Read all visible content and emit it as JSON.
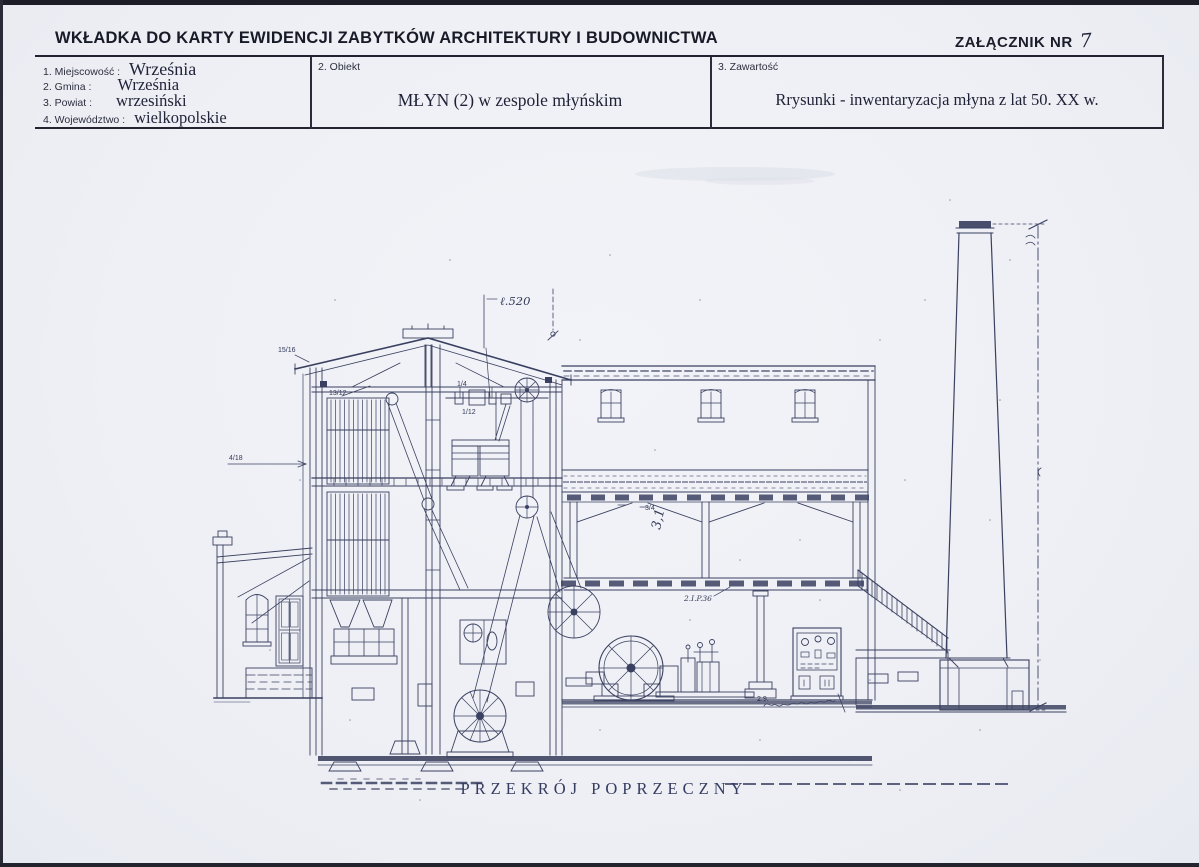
{
  "header": {
    "title": "WKŁADKA DO KARTY EWIDENCJI ZABYTKÓW ARCHITEKTURY I BUDOWNICTWA",
    "attachment_label": "ZAŁĄCZNIK NR",
    "attachment_number": "7"
  },
  "fields": {
    "miejscowosc": {
      "label": "1. Miejscowość :",
      "value": "Września"
    },
    "gmina": {
      "label": "2. Gmina :",
      "value": "Września"
    },
    "powiat": {
      "label": "3. Powiat :",
      "value": "wrzesiński"
    },
    "wojewodztwo": {
      "label": "4. Województwo :",
      "value": "wielkopolskie"
    },
    "obiekt": {
      "label": "2. Obiekt",
      "value": "MŁYN (2) w zespole młyńskim"
    },
    "zawartosc": {
      "label": "3. Zawartość",
      "value": "Rrysunki - inwentaryzacja młyna z lat 50. XX w."
    }
  },
  "drawing": {
    "caption": "PRZEKRÓJ POPRZECZNY",
    "dimension_note": "ℓ.520",
    "hall_mark": "3,1",
    "beam_mark": "2.I.P.36",
    "engine_note": "2.9.",
    "fractions": [
      "15/16",
      "4/18",
      "13/12",
      "1/4",
      "1/12",
      "3/4"
    ],
    "ink_color": "#3a4060"
  }
}
